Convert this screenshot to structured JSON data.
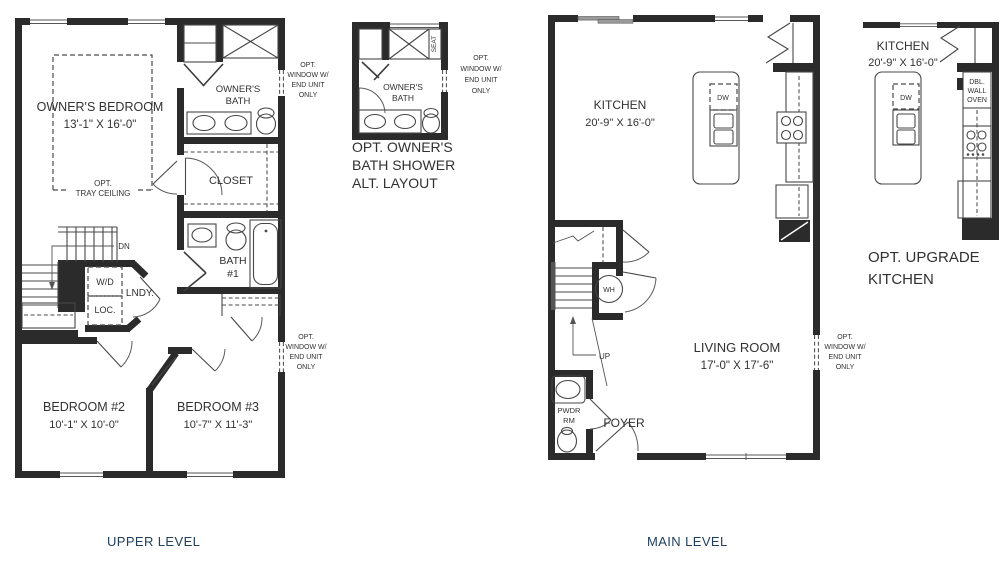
{
  "colors": {
    "ink": "#2b2b2b",
    "navy": "#21405e",
    "background": "#ffffff"
  },
  "captions": {
    "upper_level": "UPPER LEVEL",
    "main_level": "MAIN LEVEL",
    "alt_bath": [
      "OPT. OWNER'S",
      "BATH SHOWER",
      "ALT. LAYOUT"
    ],
    "upgrade_kitchen": [
      "OPT. UPGRADE",
      "KITCHEN"
    ]
  },
  "upper_level": {
    "owners_bedroom": {
      "name": "OWNER'S BEDROOM",
      "dims": "13'-1\" X 16'-0\""
    },
    "tray_ceiling": [
      "OPT.",
      "TRAY CEILING"
    ],
    "owners_bath": [
      "OWNER'S",
      "BATH"
    ],
    "closet": "CLOSET",
    "bath_1": [
      "BATH",
      "#1"
    ],
    "laundry": "LNDY.",
    "wd": "W/D",
    "loc": "LOC.",
    "dn": "DN",
    "bedroom_2": {
      "name": "BEDROOM #2",
      "dims": "10'-1\" X 10'-0\""
    },
    "bedroom_3": {
      "name": "BEDROOM #3",
      "dims": "10'-7\" X 11'-3\""
    },
    "opt_window_upper": [
      "OPT.",
      "WINDOW W/",
      "END UNIT",
      "ONLY"
    ],
    "opt_window_lower": [
      "OPT.",
      "WINDOW W/",
      "END UNIT",
      "ONLY"
    ]
  },
  "alt_bath": {
    "owners_bath": [
      "OWNER'S",
      "BATH"
    ],
    "seat": "SEAT",
    "opt_window": [
      "OPT.",
      "WINDOW W/",
      "END UNIT",
      "ONLY"
    ]
  },
  "main_level": {
    "kitchen": {
      "name": "KITCHEN",
      "dims": "20'-9\" X 16'-0\""
    },
    "dw": "DW",
    "living_room": {
      "name": "LIVING ROOM",
      "dims": "17'-0\" X 17'-6\""
    },
    "foyer": "FOYER",
    "powder_room": [
      "PWDR",
      "RM"
    ],
    "wh": "WH",
    "up": "UP",
    "opt_window": [
      "OPT.",
      "WINDOW W/",
      "END UNIT",
      "ONLY"
    ]
  },
  "upgrade_kitchen": {
    "kitchen": {
      "name": "KITCHEN",
      "dims": "20'-9\" X 16'-0\""
    },
    "dw": "DW",
    "dbl_wall_oven": [
      "DBL.",
      "WALL",
      "OVEN"
    ]
  }
}
